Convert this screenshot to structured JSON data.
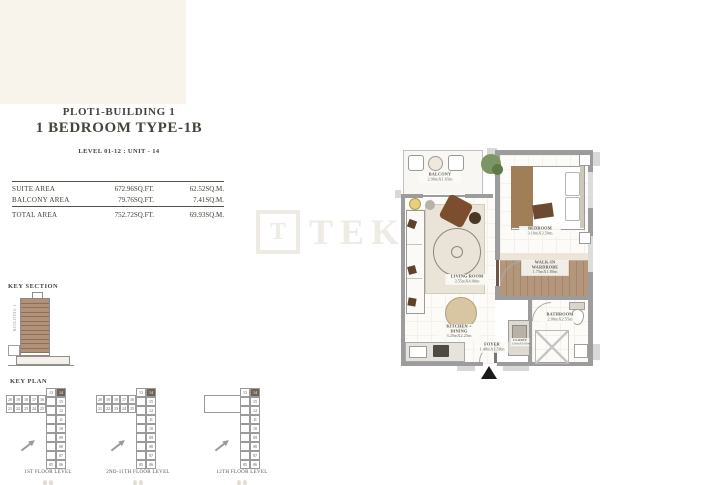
{
  "header": {
    "plot": "PLOT1-BUILDING 1",
    "unit_type": "1 BEDROOM TYPE-1B",
    "level_unit": "LEVEL 01-12 :  UNIT - 14"
  },
  "area_table": {
    "rows": [
      {
        "label": "SUITE AREA",
        "sqft": "672.96SQ.FT.",
        "sqm": "62.52SQ.M."
      },
      {
        "label": "BALCONY AREA",
        "sqft": "79.76SQ.FT.",
        "sqm": "7.41SQ.M."
      }
    ],
    "total": {
      "label": "TOTAL AREA",
      "sqft": "752.72SQ.FT.",
      "sqm": "69.93SQ.M."
    }
  },
  "key_section": {
    "title": "KEY SECTION",
    "building_label": "BUILDING 1",
    "floor_count": 12
  },
  "key_plan": {
    "title": "KEY PLAN",
    "highlight": "14",
    "wing": [
      [
        "20",
        "19",
        "18",
        "17",
        "16"
      ],
      [
        "21",
        "22",
        "23",
        "24",
        "25"
      ]
    ],
    "tower": [
      [
        "13",
        "14"
      ],
      [
        "",
        "15"
      ],
      [
        "",
        "12"
      ],
      [
        "",
        "11"
      ],
      [
        "",
        "10"
      ],
      [
        "",
        "09"
      ],
      [
        "",
        "08"
      ],
      [
        "",
        "07"
      ],
      [
        "05",
        "06"
      ]
    ],
    "plans": [
      {
        "label": "1ST FLOOR LEVEL",
        "roof": false
      },
      {
        "label": "2ND-11TH FLOOR LEVEL",
        "roof": false
      },
      {
        "label": "12TH FLOOR LEVEL",
        "roof": true
      }
    ]
  },
  "floor_plan": {
    "rooms": [
      {
        "name": "BALCONY",
        "dims": "2.90mX1.65m"
      },
      {
        "name": "LIVING ROOM",
        "dims": "3.55mX4.00m"
      },
      {
        "name": "BEDROOM",
        "dims": "3.10mX3.50m"
      },
      {
        "name": "WALK-IN WARDROBE",
        "dims": "1.75mX1.80m"
      },
      {
        "name": "KITCHEN + DINING",
        "dims": "3.25mX2.25m"
      },
      {
        "name": "FOYER",
        "dims": "1.40mX1.50m"
      },
      {
        "name": "BATHROOM",
        "dims": "2.00mX2.55m"
      },
      {
        "name": "CLOSET",
        "dims": "1.00mX0.90m"
      }
    ]
  },
  "watermark": {
    "logo_letter": "T",
    "text": "TEKCE"
  },
  "colors": {
    "header_text": "#45433a",
    "table_text": "#3e3c33",
    "key_section_floor": "#b39078",
    "unit_highlight": "#6f6257",
    "wall_gray": "#9c9c9c",
    "wardrobe_wood": "#b4977b",
    "plant_green": "#7d9463",
    "watermark": "#edebe4"
  }
}
